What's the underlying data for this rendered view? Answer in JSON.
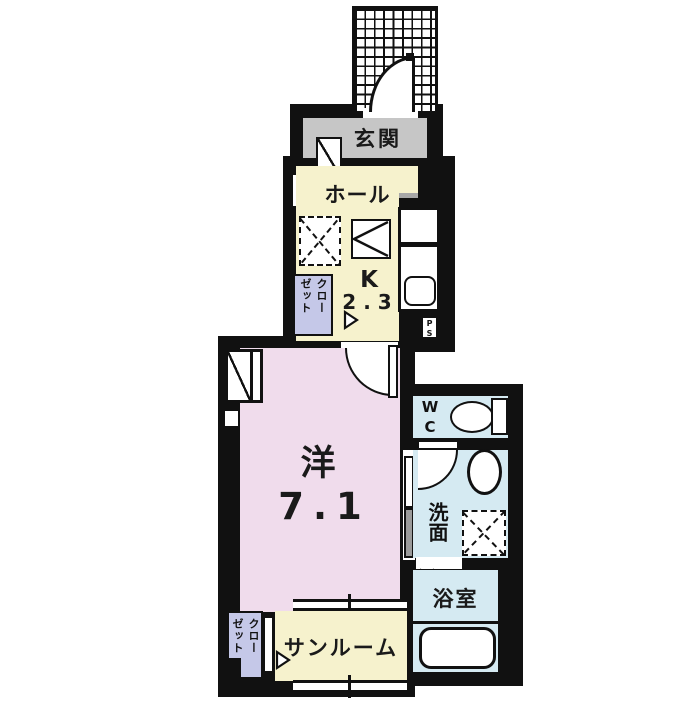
{
  "colors": {
    "wall": "#111111",
    "entrance_floor": "#c6c6c6",
    "kitchen_floor": "#f6f2cd",
    "room_floor": "#f0dcec",
    "wet_floor": "#d5eaf2",
    "closet_floor": "#c5c8e8",
    "door_gray": "#9a9a9a",
    "step_gray": "#a8a8a8"
  },
  "rooms": {
    "genkan": {
      "label": "玄関"
    },
    "hall": {
      "label": "ホール"
    },
    "kitchen": {
      "label": "K",
      "size": "2.3"
    },
    "closet_upper": {
      "col1": "クロー",
      "col2": "ゼット"
    },
    "main": {
      "label": "洋",
      "size": "7.1"
    },
    "wc": {
      "line1": "W",
      "line2": "C"
    },
    "washroom": {
      "label": "洗面"
    },
    "bathroom": {
      "label": "浴室"
    },
    "sunroom": {
      "label": "サンルーム"
    },
    "closet_lower": {
      "col1": "クロー",
      "col2": "ゼット"
    }
  },
  "pipe_spaces": {
    "upper": {
      "line1": "P",
      "line2": "S"
    },
    "lower": {
      "line1": "P",
      "line2": "S"
    }
  }
}
